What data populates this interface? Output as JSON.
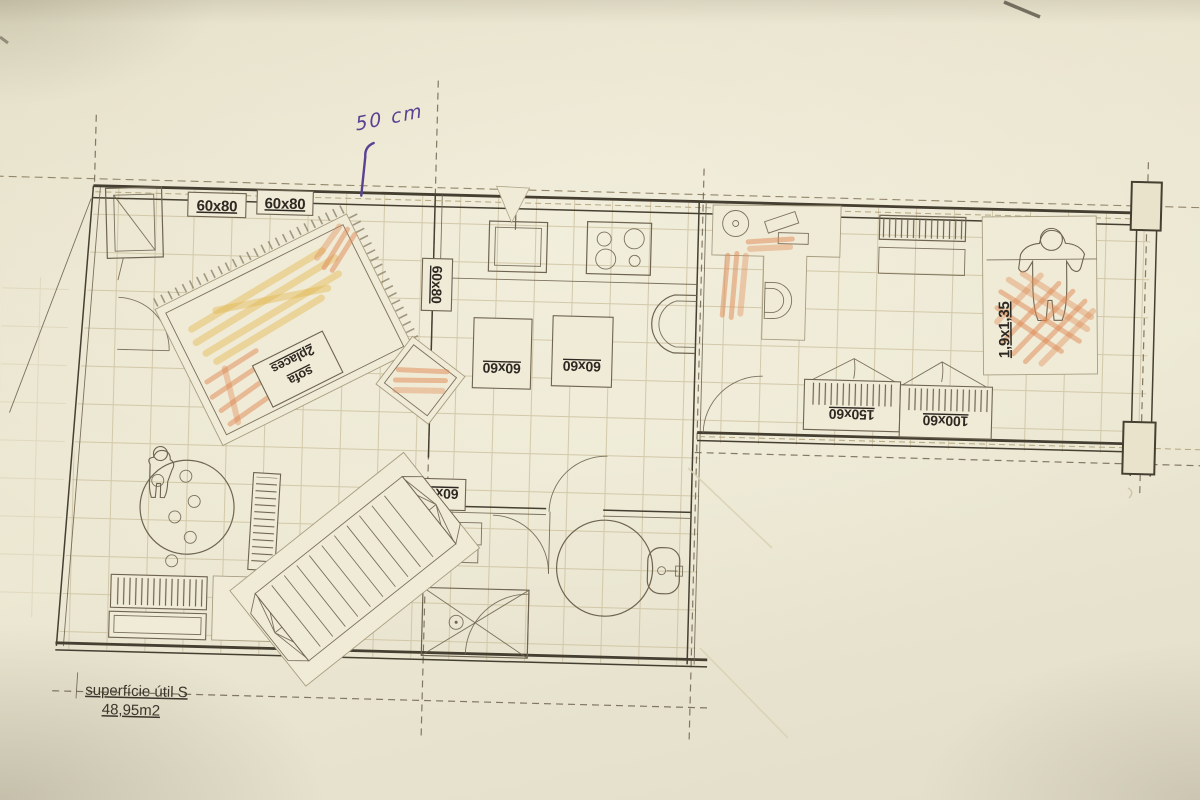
{
  "scene": "photograph of a hand-annotated apartment floor plan with paper furniture cutouts and pencil shading",
  "colors": {
    "paper": "#e8e3ca",
    "cutout": "#f0ebd7",
    "line": "#6e6450",
    "line_dark": "#453f32",
    "grid": "#cec2a0",
    "dash": "#93866a",
    "orange": "#dd8852",
    "yellow": "#e2b94f",
    "purple": "#5a4192",
    "ink": "#2d2822"
  },
  "labels": {
    "desk_a": "60x80",
    "desk_b": "60x80",
    "side_60x80": "60x80",
    "table_60x60_a": "60x60",
    "table_60x60_b": "60x60",
    "table_60x60_c": "60x60",
    "sofa_line1": "sofa",
    "sofa_line2": "2places",
    "bed_size": "1,9x1,35",
    "wardrobe_large": "150x60",
    "wardrobe_small": "100x60"
  },
  "annotations": {
    "handwritten_note": "50 cm",
    "area_title": "superfície útil S",
    "area_value": "48,95m2"
  }
}
